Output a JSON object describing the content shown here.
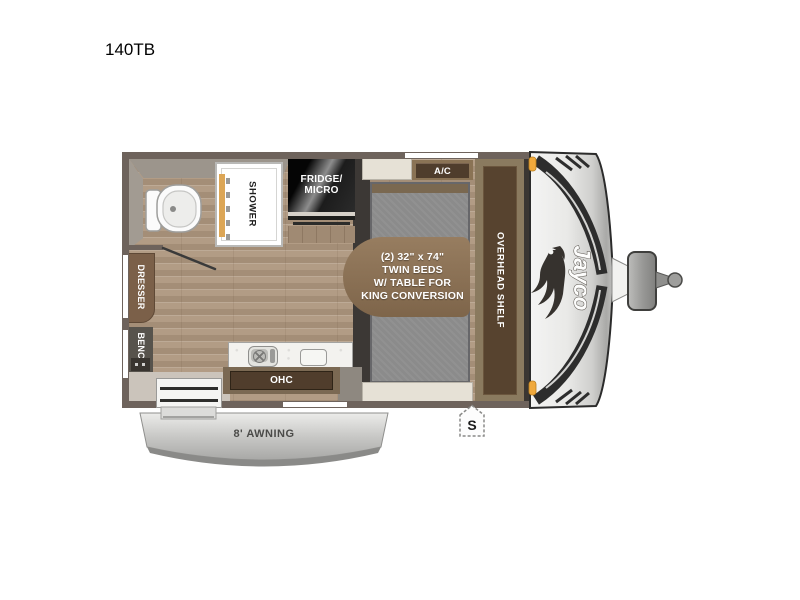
{
  "title": "140TB",
  "floorplan": {
    "labels": {
      "shower": "SHOWER",
      "fridge_line1": "FRIDGE/",
      "fridge_line2": "MICRO",
      "ac": "A/C",
      "bed_line1": "(2) 32\" x 74\"",
      "bed_line2": "TWIN BEDS",
      "bed_line3": "W/ TABLE FOR",
      "bed_line4": "KING CONVERSION",
      "overhead_shelf": "OVERHEAD SHELF",
      "dresser": "DRESSER",
      "bench": "BENCH",
      "ohc": "OHC",
      "awning": "8' AWNING",
      "speaker": "S",
      "brand": "Jayco"
    },
    "colors": {
      "wall": "#6e635c",
      "wood_floor": "#b29c85",
      "cabinet_wood_dark": "#503d2c",
      "cabinet_wood_frame": "#8a7355",
      "table_wood": "#8a7054",
      "mattress_gray": "#8b8b8b",
      "fridge_black": "#121212",
      "dresser_brown": "#7b6049",
      "bench_gray": "#57534c",
      "cream_cabinet": "#e6e1d6",
      "awning_gray": "#bcbcba",
      "marker_light_amber": "#f0a93c",
      "cap_silver": "#d9d9d8",
      "graphic_dark": "#2d2d2d"
    }
  }
}
